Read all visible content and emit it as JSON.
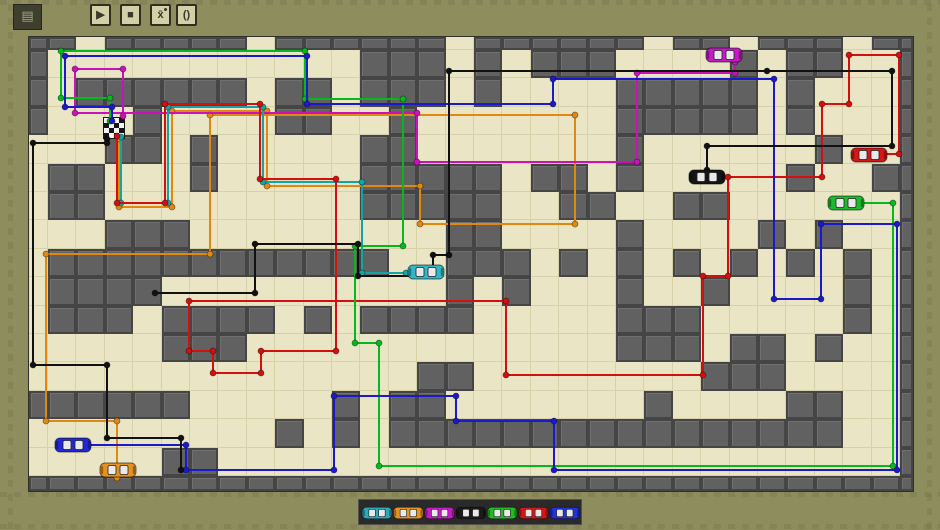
{
  "toolbar": {
    "app_icon_glyph": "▤",
    "buttons": [
      {
        "name": "play",
        "glyph": "▶"
      },
      {
        "name": "stop",
        "glyph": "■"
      },
      {
        "name": "waypoint",
        "glyph": "x̄",
        "has_dot": true
      },
      {
        "name": "brackets",
        "glyph": "()"
      }
    ]
  },
  "colors": {
    "frame": "#8d8d5d",
    "floor": "#eae6c5",
    "grid_line": "#d6d1a9",
    "wall": "#616161",
    "palette_bg": "#2a2a2a"
  },
  "board": {
    "cols": 32,
    "rows": 17,
    "flag_cell": {
      "col": 3,
      "row": 3
    },
    "walls": [
      [
        0,
        0,
        2,
        1
      ],
      [
        3,
        0,
        5,
        1
      ],
      [
        9,
        0,
        6,
        1
      ],
      [
        16,
        0,
        6,
        1
      ],
      [
        23,
        0,
        2,
        1
      ],
      [
        26,
        0,
        3,
        1
      ],
      [
        30,
        0,
        2,
        1
      ],
      [
        0,
        1,
        1,
        3
      ],
      [
        12,
        1,
        3,
        2
      ],
      [
        16,
        1,
        1,
        2
      ],
      [
        18,
        1,
        3,
        1
      ],
      [
        25,
        1,
        1,
        1
      ],
      [
        27,
        1,
        2,
        1
      ],
      [
        2,
        2,
        6,
        1
      ],
      [
        9,
        2,
        2,
        2
      ],
      [
        21,
        2,
        5,
        2
      ],
      [
        27,
        2,
        1,
        1
      ],
      [
        4,
        3,
        1,
        1
      ],
      [
        13,
        3,
        1,
        1
      ],
      [
        27,
        3,
        1,
        1
      ],
      [
        3,
        4,
        2,
        1
      ],
      [
        6,
        4,
        1,
        2
      ],
      [
        12,
        4,
        2,
        3
      ],
      [
        21,
        4,
        1,
        2
      ],
      [
        28,
        4,
        1,
        1
      ],
      [
        1,
        5,
        2,
        2
      ],
      [
        14,
        5,
        3,
        2
      ],
      [
        18,
        5,
        2,
        1
      ],
      [
        27,
        5,
        1,
        1
      ],
      [
        30,
        5,
        1,
        1
      ],
      [
        19,
        6,
        2,
        1
      ],
      [
        23,
        6,
        2,
        1
      ],
      [
        3,
        7,
        3,
        1
      ],
      [
        15,
        7,
        2,
        1
      ],
      [
        21,
        7,
        1,
        1
      ],
      [
        26,
        7,
        1,
        1
      ],
      [
        28,
        7,
        1,
        1
      ],
      [
        1,
        8,
        3,
        3
      ],
      [
        4,
        8,
        5,
        1
      ],
      [
        9,
        8,
        2,
        1
      ],
      [
        11,
        8,
        2,
        1
      ],
      [
        15,
        8,
        3,
        1
      ],
      [
        19,
        8,
        1,
        1
      ],
      [
        21,
        8,
        1,
        2
      ],
      [
        23,
        8,
        1,
        1
      ],
      [
        25,
        8,
        1,
        1
      ],
      [
        27,
        8,
        1,
        1
      ],
      [
        29,
        8,
        1,
        1
      ],
      [
        4,
        9,
        1,
        1
      ],
      [
        15,
        9,
        1,
        2
      ],
      [
        17,
        9,
        1,
        1
      ],
      [
        24,
        9,
        1,
        1
      ],
      [
        29,
        9,
        1,
        2
      ],
      [
        5,
        10,
        3,
        2
      ],
      [
        8,
        10,
        1,
        1
      ],
      [
        10,
        10,
        1,
        1
      ],
      [
        12,
        10,
        3,
        1
      ],
      [
        21,
        10,
        3,
        2
      ],
      [
        25,
        11,
        2,
        2
      ],
      [
        28,
        11,
        1,
        1
      ],
      [
        14,
        12,
        2,
        1
      ],
      [
        24,
        12,
        1,
        1
      ],
      [
        0,
        13,
        6,
        1
      ],
      [
        11,
        13,
        1,
        2
      ],
      [
        13,
        13,
        2,
        1
      ],
      [
        22,
        13,
        1,
        1
      ],
      [
        27,
        13,
        2,
        1
      ],
      [
        9,
        14,
        1,
        1
      ],
      [
        13,
        14,
        15,
        1
      ],
      [
        28,
        14,
        1,
        1
      ],
      [
        5,
        15,
        2,
        1
      ],
      [
        0,
        16,
        32,
        1
      ],
      [
        31,
        0,
        1,
        17
      ]
    ]
  },
  "cars": [
    {
      "color": "magenta",
      "hex": "#c51bc5",
      "x": 724,
      "y": 55
    },
    {
      "color": "red",
      "hex": "#d61616",
      "x": 869,
      "y": 155
    },
    {
      "color": "green",
      "hex": "#1dba2d",
      "x": 846,
      "y": 203
    },
    {
      "color": "black",
      "hex": "#151515",
      "x": 707,
      "y": 177
    },
    {
      "color": "cyan",
      "hex": "#31b7c7",
      "x": 426,
      "y": 272
    },
    {
      "color": "blue",
      "hex": "#2228d8",
      "x": 73,
      "y": 445
    },
    {
      "color": "orange",
      "hex": "#e6921e",
      "x": 118,
      "y": 470
    }
  ],
  "paths": [
    {
      "color": "orange",
      "hex": "#e0880f",
      "points": [
        [
          117,
          478
        ],
        [
          117,
          421
        ],
        [
          46,
          421
        ],
        [
          46,
          254
        ],
        [
          210,
          254
        ],
        [
          210,
          115
        ],
        [
          575,
          115
        ],
        [
          575,
          224
        ],
        [
          420,
          224
        ],
        [
          420,
          186
        ],
        [
          267,
          186
        ],
        [
          267,
          111
        ],
        [
          172,
          111
        ],
        [
          172,
          207
        ],
        [
          119,
          207
        ],
        [
          119,
          139
        ]
      ]
    },
    {
      "color": "magenta",
      "hex": "#cc11bb",
      "points": [
        [
          735,
          62
        ],
        [
          735,
          73
        ],
        [
          637,
          73
        ],
        [
          637,
          162
        ],
        [
          417,
          162
        ],
        [
          417,
          113
        ],
        [
          75,
          113
        ],
        [
          75,
          69
        ],
        [
          123,
          69
        ],
        [
          123,
          116
        ]
      ]
    },
    {
      "color": "teal",
      "hex": "#12a5a5",
      "points": [
        [
          121,
          137
        ],
        [
          121,
          203
        ],
        [
          168,
          203
        ],
        [
          168,
          107
        ],
        [
          263,
          107
        ],
        [
          263,
          182
        ],
        [
          362,
          182
        ],
        [
          362,
          273
        ],
        [
          406,
          273
        ]
      ]
    },
    {
      "color": "red",
      "hex": "#d40f0f",
      "points": [
        [
          880,
          154
        ],
        [
          899,
          154
        ],
        [
          899,
          55
        ],
        [
          849,
          55
        ],
        [
          849,
          104
        ],
        [
          822,
          104
        ],
        [
          822,
          177
        ],
        [
          728,
          177
        ],
        [
          728,
          276
        ],
        [
          703,
          276
        ],
        [
          703,
          375
        ],
        [
          506,
          375
        ],
        [
          506,
          301
        ],
        [
          189,
          301
        ],
        [
          189,
          351
        ],
        [
          213,
          351
        ],
        [
          213,
          373
        ],
        [
          261,
          373
        ],
        [
          261,
          351
        ],
        [
          336,
          351
        ],
        [
          336,
          179
        ],
        [
          260,
          179
        ],
        [
          260,
          104
        ],
        [
          165,
          104
        ],
        [
          165,
          203
        ],
        [
          117,
          203
        ],
        [
          117,
          136
        ]
      ]
    },
    {
      "color": "green",
      "hex": "#06b81f",
      "points": [
        [
          850,
          203
        ],
        [
          893,
          203
        ],
        [
          893,
          466
        ],
        [
          379,
          466
        ],
        [
          379,
          343
        ],
        [
          355,
          343
        ],
        [
          355,
          246
        ],
        [
          403,
          246
        ],
        [
          403,
          99
        ],
        [
          305,
          99
        ],
        [
          305,
          51
        ],
        [
          61,
          51
        ],
        [
          61,
          98
        ],
        [
          110,
          98
        ],
        [
          110,
          121
        ]
      ]
    },
    {
      "color": "blue",
      "hex": "#1a1acc",
      "points": [
        [
          75,
          445
        ],
        [
          186,
          445
        ],
        [
          186,
          470
        ],
        [
          334,
          470
        ],
        [
          334,
          396
        ],
        [
          456,
          396
        ],
        [
          456,
          421
        ],
        [
          554,
          421
        ],
        [
          554,
          470
        ],
        [
          897,
          470
        ],
        [
          897,
          224
        ],
        [
          821,
          224
        ],
        [
          821,
          299
        ],
        [
          774,
          299
        ],
        [
          774,
          79
        ],
        [
          553,
          79
        ],
        [
          553,
          104
        ],
        [
          307,
          104
        ],
        [
          307,
          56
        ],
        [
          65,
          56
        ],
        [
          65,
          107
        ],
        [
          112,
          107
        ],
        [
          112,
          121
        ]
      ]
    },
    {
      "color": "black",
      "hex": "#111111",
      "points": [
        [
          107,
          139
        ],
        [
          107,
          143
        ],
        [
          33,
          143
        ],
        [
          33,
          365
        ],
        [
          107,
          365
        ],
        [
          107,
          438
        ],
        [
          181,
          438
        ],
        [
          181,
          470
        ]
      ]
    },
    {
      "color": "black",
      "hex": "#111111",
      "points": [
        [
          707,
          170
        ],
        [
          707,
          146
        ],
        [
          892,
          146
        ],
        [
          892,
          71
        ],
        [
          767,
          71
        ],
        [
          449,
          71
        ],
        [
          449,
          255
        ],
        [
          433,
          255
        ],
        [
          433,
          276
        ],
        [
          358,
          276
        ],
        [
          358,
          244
        ],
        [
          255,
          244
        ],
        [
          255,
          293
        ],
        [
          155,
          293
        ]
      ]
    }
  ],
  "palette": {
    "cars": [
      {
        "color": "teal",
        "hex": "#2aa9bb"
      },
      {
        "color": "orange",
        "hex": "#e6921e"
      },
      {
        "color": "magenta",
        "hex": "#c51bc5"
      },
      {
        "color": "black",
        "hex": "#1a1a1a"
      },
      {
        "color": "green",
        "hex": "#22bb22"
      },
      {
        "color": "red",
        "hex": "#d01818"
      },
      {
        "color": "blue",
        "hex": "#2233dd"
      }
    ]
  }
}
